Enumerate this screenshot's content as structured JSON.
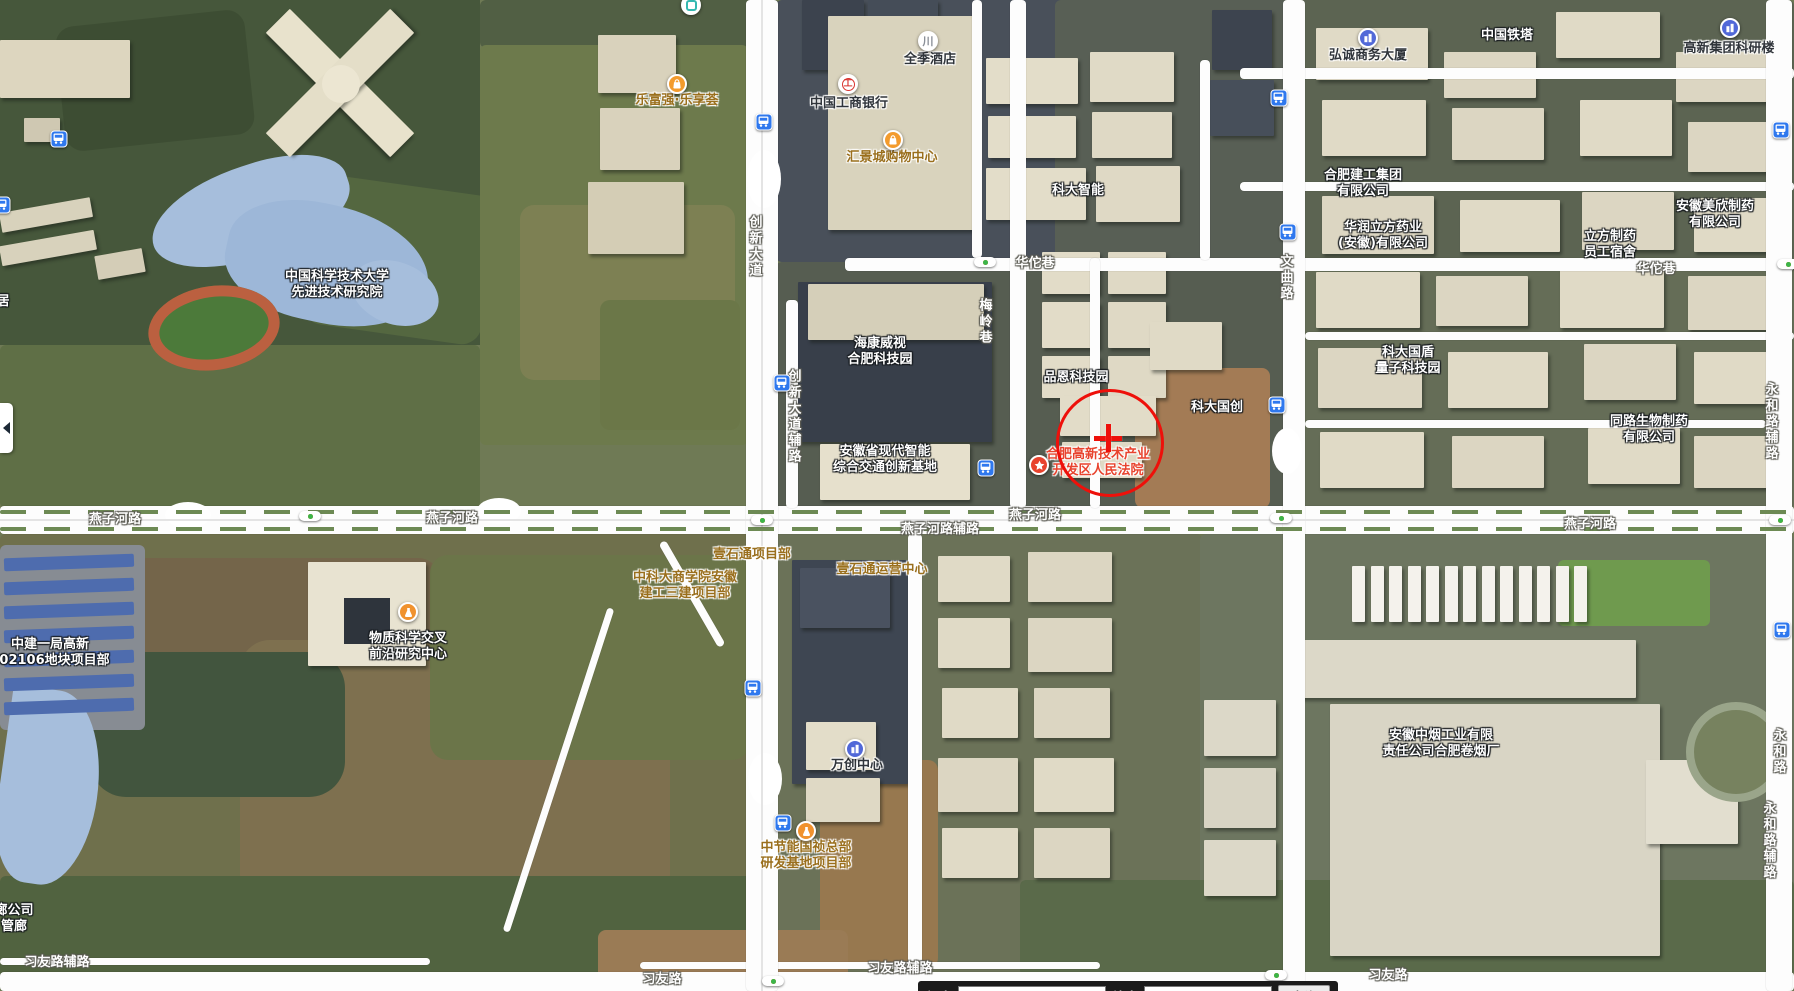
{
  "map": {
    "view": "satellite",
    "marker": {
      "shape": "circle-with-crosshair",
      "color": "#ee100a",
      "center_x": 1110,
      "center_y": 443,
      "radius": 54,
      "cross_x": 1108,
      "cross_y": 438
    },
    "poi_labels": [
      {
        "lines": [
          "中国科学技术大学",
          "先进技术研究院"
        ],
        "x": 337,
        "y": 285,
        "style": "white"
      },
      {
        "lines": [
          "科大智能"
        ],
        "x": 1078,
        "y": 191,
        "style": "white"
      },
      {
        "lines": [
          "海康威视",
          "合肥科技园"
        ],
        "x": 880,
        "y": 352,
        "style": "white"
      },
      {
        "lines": [
          "品恩科技园"
        ],
        "x": 1076,
        "y": 378,
        "style": "white"
      },
      {
        "lines": [
          "科大国创"
        ],
        "x": 1217,
        "y": 408,
        "style": "white"
      },
      {
        "lines": [
          "科大国盾",
          "量子科技园"
        ],
        "x": 1408,
        "y": 361,
        "style": "white"
      },
      {
        "lines": [
          "同路生物制药",
          "有限公司"
        ],
        "x": 1649,
        "y": 430,
        "style": "white"
      },
      {
        "lines": [
          "合肥建工集团",
          "有限公司"
        ],
        "x": 1363,
        "y": 184,
        "style": "white"
      },
      {
        "lines": [
          "安徽美欣制药",
          "有限公司"
        ],
        "x": 1715,
        "y": 215,
        "style": "white"
      },
      {
        "lines": [
          "华润立方药业",
          "(安徽)有限公司"
        ],
        "x": 1383,
        "y": 236,
        "style": "white"
      },
      {
        "lines": [
          "立方制药",
          "员工宿舍"
        ],
        "x": 1610,
        "y": 245,
        "style": "white"
      },
      {
        "lines": [
          "中国铁塔"
        ],
        "x": 1507,
        "y": 36,
        "style": "white"
      },
      {
        "lines": [
          "安徽省现代智能",
          "综合交通创新基地"
        ],
        "x": 885,
        "y": 460,
        "style": "white"
      },
      {
        "lines": [
          "物质科学交叉",
          "前沿研究中心"
        ],
        "x": 408,
        "y": 647,
        "style": "white"
      },
      {
        "lines": [
          "安徽中烟工业有限",
          "责任公司合肥卷烟厂"
        ],
        "x": 1441,
        "y": 744,
        "style": "white"
      },
      {
        "lines": [
          "中建一局高新",
          "202106地块项目部"
        ],
        "x": 50,
        "y": 653,
        "style": "white"
      },
      {
        "lines": [
          "居"
        ],
        "x": 3,
        "y": 302,
        "style": "white"
      },
      {
        "lines": [
          "廊公司",
          "管廊"
        ],
        "x": 14,
        "y": 919,
        "style": "white"
      },
      {
        "lines": [
          "全季酒店"
        ],
        "x": 930,
        "y": 60,
        "style": "dark"
      },
      {
        "lines": [
          "中国工商银行"
        ],
        "x": 849,
        "y": 104,
        "style": "dark"
      },
      {
        "lines": [
          "弘诚商务大厦"
        ],
        "x": 1368,
        "y": 56,
        "style": "dark"
      },
      {
        "lines": [
          "高新集团科研楼"
        ],
        "x": 1729,
        "y": 49,
        "style": "dark"
      },
      {
        "lines": [
          "万创中心"
        ],
        "x": 857,
        "y": 766,
        "style": "dark"
      },
      {
        "lines": [
          "乐富强·乐享荟"
        ],
        "x": 677,
        "y": 101,
        "style": "gold"
      },
      {
        "lines": [
          "汇景城购物中心"
        ],
        "x": 892,
        "y": 158,
        "style": "gold"
      },
      {
        "lines": [
          "壹石通项目部"
        ],
        "x": 752,
        "y": 555,
        "style": "gold"
      },
      {
        "lines": [
          "壹石通运营中心"
        ],
        "x": 882,
        "y": 570,
        "style": "gold"
      },
      {
        "lines": [
          "中科大商学院安徽",
          "建工三建项目部"
        ],
        "x": 685,
        "y": 586,
        "style": "gold"
      },
      {
        "lines": [
          "中节能国祯总部",
          "研发基地项目部"
        ],
        "x": 806,
        "y": 856,
        "style": "gold"
      },
      {
        "lines": [
          "合肥高新技术产业",
          "开发区人民法院"
        ],
        "x": 1098,
        "y": 463,
        "style": "red"
      }
    ],
    "poi_icons": [
      {
        "type": "bag",
        "x": 677,
        "y": 84
      },
      {
        "type": "bag",
        "x": 893,
        "y": 140
      },
      {
        "type": "bank",
        "x": 848,
        "y": 84
      },
      {
        "type": "hotel",
        "x": 928,
        "y": 41
      },
      {
        "type": "building",
        "x": 1368,
        "y": 38
      },
      {
        "type": "building",
        "x": 1730,
        "y": 28
      },
      {
        "type": "building",
        "x": 855,
        "y": 749
      },
      {
        "type": "flask",
        "x": 408,
        "y": 612
      },
      {
        "type": "flask",
        "x": 806,
        "y": 831
      },
      {
        "type": "star",
        "x": 1039,
        "y": 465
      },
      {
        "type": "misc",
        "x": 691,
        "y": 5
      }
    ],
    "road_labels": [
      {
        "text": "燕子河路",
        "x": 115,
        "y": 520
      },
      {
        "text": "燕子河路",
        "x": 452,
        "y": 519
      },
      {
        "text": "燕子河路",
        "x": 1035,
        "y": 516
      },
      {
        "text": "燕子河路",
        "x": 1590,
        "y": 525
      },
      {
        "text": "燕子河路辅路",
        "x": 940,
        "y": 530
      },
      {
        "text": "华佗巷",
        "x": 1035,
        "y": 264
      },
      {
        "text": "华佗巷",
        "x": 1656,
        "y": 270
      },
      {
        "text": "习友路",
        "x": 662,
        "y": 980
      },
      {
        "text": "习友路",
        "x": 1388,
        "y": 976
      },
      {
        "text": "习友路辅路",
        "x": 57,
        "y": 963
      },
      {
        "text": "习友路辅路",
        "x": 900,
        "y": 969
      }
    ],
    "vertical_road_labels": [
      {
        "text": "创新大道",
        "x": 754,
        "y": 247
      },
      {
        "text": "创新大道辅路",
        "x": 793,
        "y": 417
      },
      {
        "text": "文曲路",
        "x": 1285,
        "y": 278
      },
      {
        "text": "梅岭巷",
        "x": 984,
        "y": 322
      },
      {
        "text": "永和路辅路",
        "x": 1770,
        "y": 422
      },
      {
        "text": "永和路",
        "x": 1778,
        "y": 752
      },
      {
        "text": "永和路辅路",
        "x": 1768,
        "y": 841
      }
    ],
    "bus_stops": [
      [
        59,
        139
      ],
      [
        2,
        205
      ],
      [
        764,
        122
      ],
      [
        1279,
        98
      ],
      [
        1288,
        232
      ],
      [
        1781,
        130
      ],
      [
        1277,
        405
      ],
      [
        782,
        383
      ],
      [
        986,
        468
      ],
      [
        753,
        688
      ],
      [
        783,
        823
      ],
      [
        1782,
        630
      ]
    ],
    "traffic_lights": [
      [
        985,
        262
      ],
      [
        1788,
        264
      ],
      [
        310,
        516
      ],
      [
        762,
        520
      ],
      [
        1281,
        518
      ],
      [
        1780,
        520
      ],
      [
        1276,
        975
      ],
      [
        773,
        981
      ]
    ],
    "colors": {
      "accent_marker": "#ee100a",
      "bus_icon": "#2f78ee",
      "poi_bag": "#f39b2d",
      "poi_flask": "#f0922e",
      "poi_building": "#5168d8",
      "poi_star": "#e8432e",
      "bank_red": "#d9332e"
    }
  },
  "coordinate_bar": {
    "lon_label": "经度",
    "lon_value": "117.1878978978597",
    "lat_label": "纬度",
    "lat_value": "31.82589845474594",
    "search_label": "查询"
  }
}
